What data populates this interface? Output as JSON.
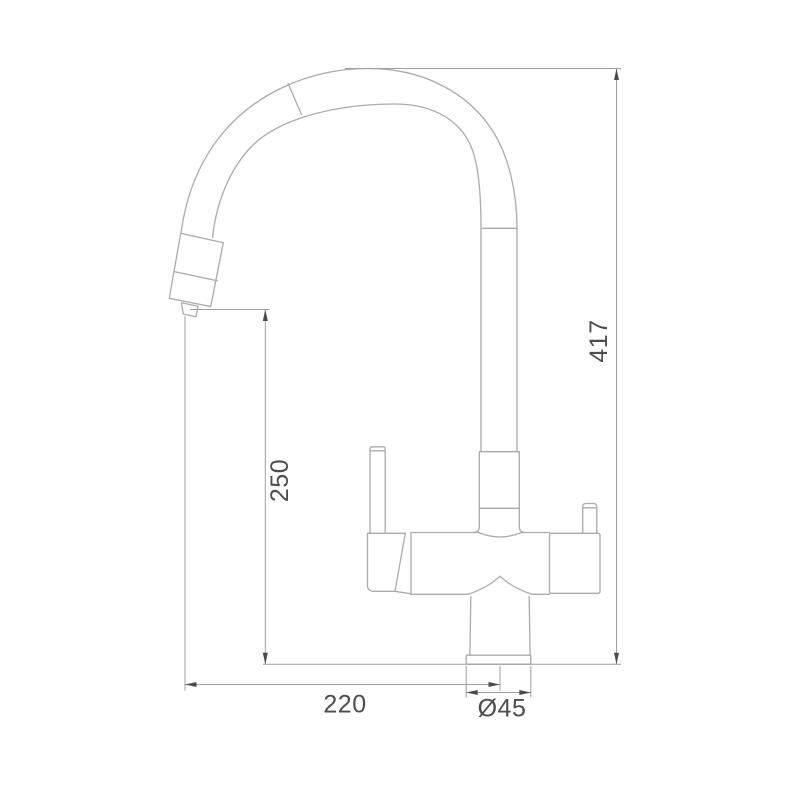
{
  "drawing": {
    "kind": "technical dimension drawing",
    "subject": "kitchen faucet with gooseneck spout, side elevation view"
  },
  "dimensions": {
    "overall_height": {
      "label": "417",
      "orientation": "vertical",
      "measures": "total faucet height from base line to top of spout arc"
    },
    "spout_outlet_height": {
      "label": "250",
      "orientation": "vertical",
      "measures": "height from base line to spout outlet"
    },
    "spout_reach": {
      "label": "220",
      "orientation": "horizontal",
      "measures": "horizontal reach from faucet centerline to spout outlet"
    },
    "base_diameter": {
      "label": "Ø45",
      "orientation": "horizontal",
      "measures": "base flange diameter"
    }
  },
  "colors": {
    "outline": "#a9abad",
    "dimension_line": "#9d9fa1",
    "arrow": "#4b4b4b",
    "text": "#4d4d4d",
    "background": "#ffffff"
  }
}
